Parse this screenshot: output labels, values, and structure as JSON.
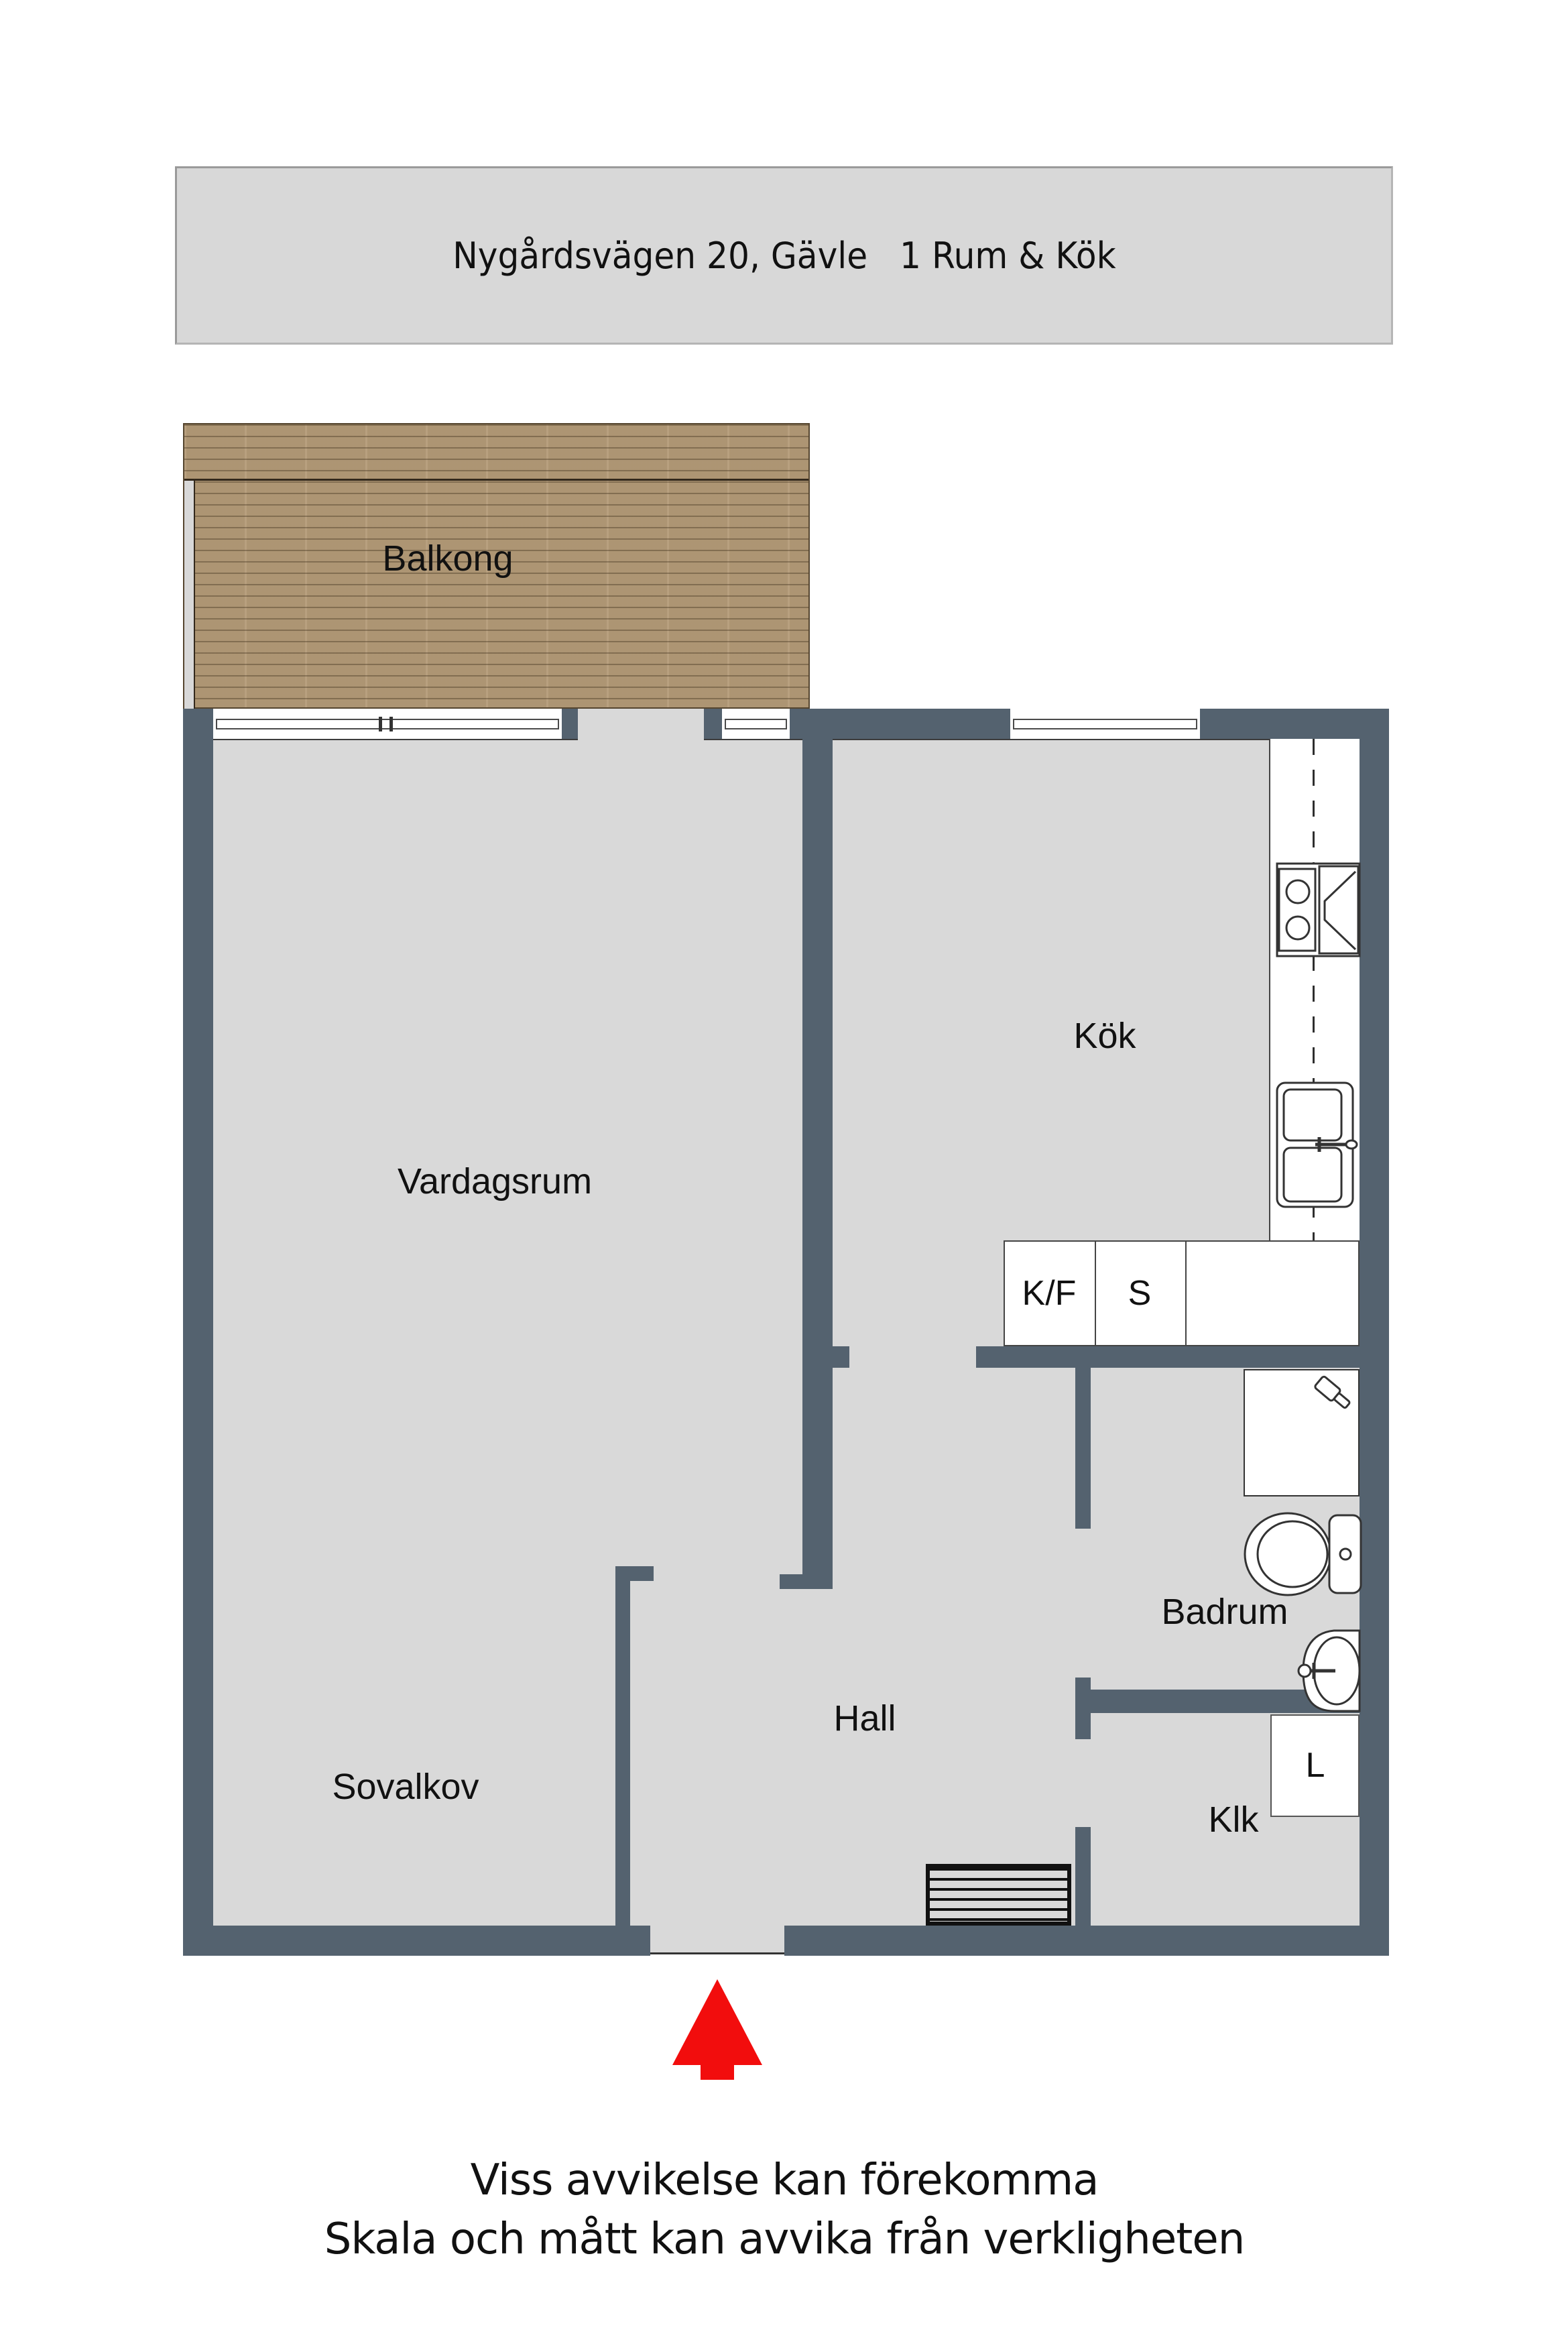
{
  "title_bar": {
    "text": "Nygårdsvägen 20, Gävle   1 Rum & Kök"
  },
  "rooms": {
    "balcony": {
      "label": "Balkong"
    },
    "living": {
      "label": "Vardagsrum"
    },
    "kitchen": {
      "label": "Kök"
    },
    "sleeping": {
      "label": "Sovalkov"
    },
    "hall": {
      "label": "Hall"
    },
    "bathroom": {
      "label": "Badrum"
    },
    "closet": {
      "label": "Klk"
    }
  },
  "appliances": {
    "fridge_freezer": {
      "label": "K/F"
    },
    "stove_cabinet": {
      "label": "S"
    },
    "linen_closet": {
      "label": "L"
    }
  },
  "footer": {
    "line1": "Viss avvikelse kan förekomma",
    "line2": "Skala och mått kan avvika från verkligheten"
  },
  "colors": {
    "wall": "#54626f",
    "floor": "#d9d9d9",
    "title_bar_bg": "#d8d8d8",
    "balcony_wood": "#b49b78",
    "entrance_arrow": "#f20d0d",
    "text": "#111111"
  }
}
